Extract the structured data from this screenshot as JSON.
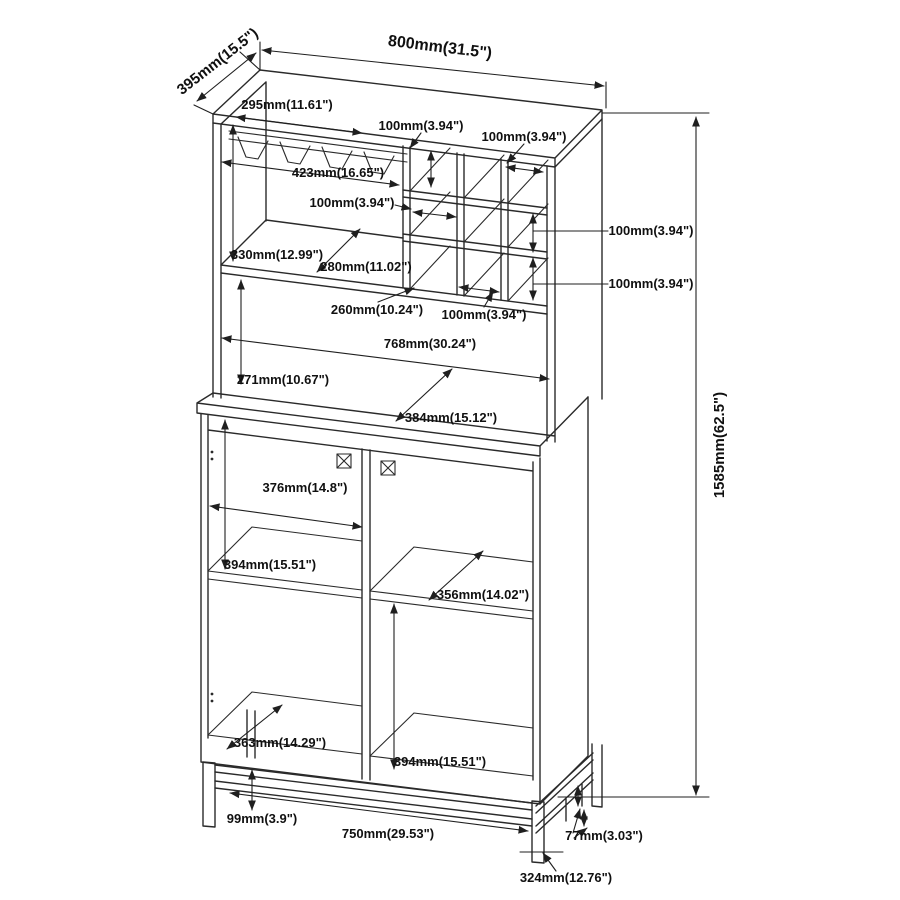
{
  "diagram": {
    "title": "Bar cabinet line drawing with dimensions",
    "type": "furniture-dimension-diagram",
    "units": "millimeters (inches)",
    "colors": {
      "line": "#2a2a2a",
      "text": "#101010",
      "background": "#ffffff"
    },
    "overall": {
      "width": "800mm(31.5\")",
      "depth": "395mm(15.5\")",
      "height": "1585mm(62.5\")"
    },
    "labels": {
      "d395": "395mm(15.5\")",
      "d800": "800mm(31.5\")",
      "d295": "295mm(11.61\")",
      "d100": "100mm(3.94\")",
      "d423": "423mm(16.65\")",
      "d330": "330mm(12.99\")",
      "d280": "280mm(11.02\")",
      "d260": "260mm(10.24\")",
      "d768": "768mm(30.24\")",
      "d271": "271mm(10.67\")",
      "d384": "384mm(15.12\")",
      "d376": "376mm(14.8\")",
      "d394": "394mm(15.51\")",
      "d356": "356mm(14.02\")",
      "d363": "363mm(14.29\")",
      "d99": "99mm(3.9\")",
      "d750": "750mm(29.53\")",
      "d77": "77mm(3.03\")",
      "d324": "324mm(12.76\")",
      "d1585": "1585mm(62.5\")"
    },
    "dimensions": [
      {
        "id": "overall-width",
        "mm": 800,
        "inches": 31.5
      },
      {
        "id": "overall-depth",
        "mm": 395,
        "inches": 15.5
      },
      {
        "id": "overall-height",
        "mm": 1585,
        "inches": 62.5
      },
      {
        "id": "counter-depth",
        "mm": 295,
        "inches": 11.61
      },
      {
        "id": "stem-rack-width",
        "mm": 423,
        "inches": 16.65
      },
      {
        "id": "cubby-size",
        "mm": 100,
        "inches": 3.94
      },
      {
        "id": "upper-left-opening-height",
        "mm": 330,
        "inches": 12.99
      },
      {
        "id": "shelf-depth-upper",
        "mm": 280,
        "inches": 11.02
      },
      {
        "id": "cubby-bottom-width",
        "mm": 260,
        "inches": 10.24
      },
      {
        "id": "interior-width-hutch",
        "mm": 768,
        "inches": 30.24
      },
      {
        "id": "hutch-lower-opening-height",
        "mm": 271,
        "inches": 10.67
      },
      {
        "id": "base-top-depth",
        "mm": 384,
        "inches": 15.12
      },
      {
        "id": "door-opening-width",
        "mm": 376,
        "inches": 14.8
      },
      {
        "id": "cabinet-opening-height",
        "mm": 394,
        "inches": 15.51
      },
      {
        "id": "shelf-depth-lower",
        "mm": 356,
        "inches": 14.02
      },
      {
        "id": "bottom-shelf-depth",
        "mm": 363,
        "inches": 14.29
      },
      {
        "id": "frame-height",
        "mm": 99,
        "inches": 3.9
      },
      {
        "id": "frame-width",
        "mm": 750,
        "inches": 29.53
      },
      {
        "id": "frame-tube",
        "mm": 77,
        "inches": 3.03
      },
      {
        "id": "frame-depth",
        "mm": 324,
        "inches": 12.76
      }
    ]
  }
}
